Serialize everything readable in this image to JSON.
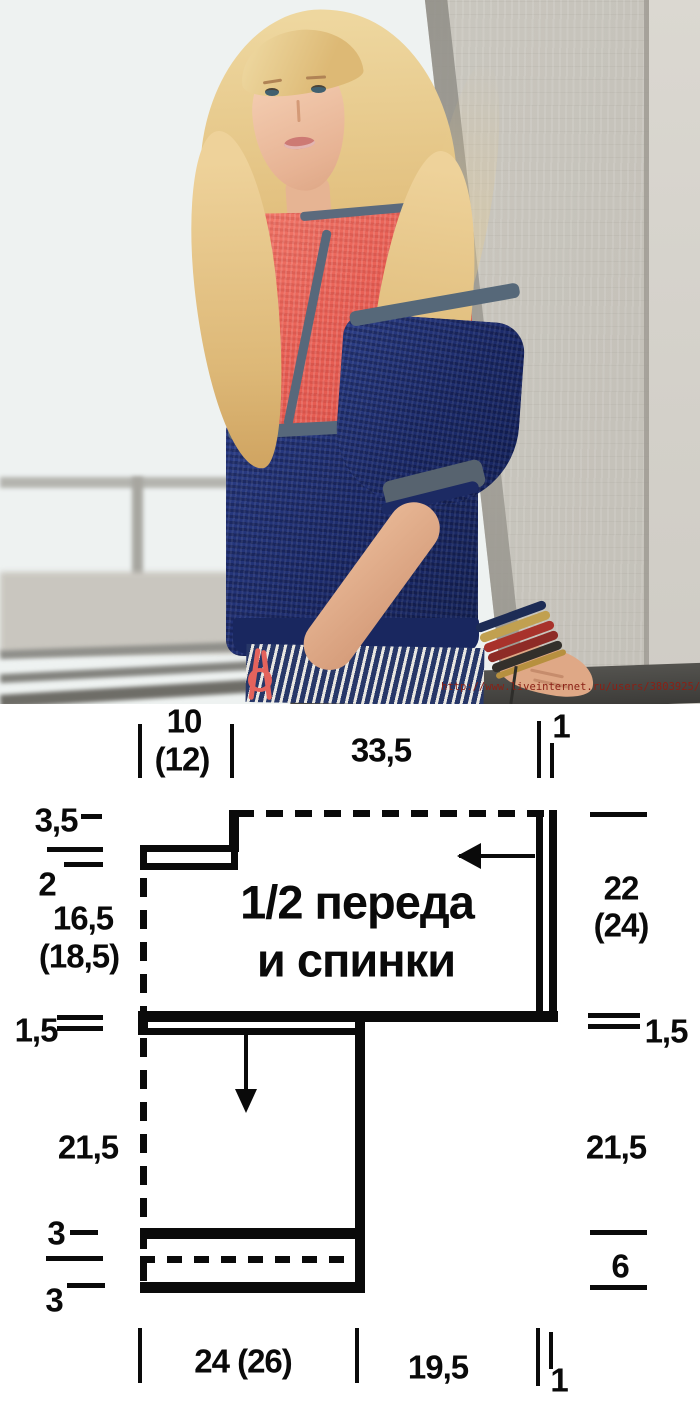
{
  "photo": {
    "watermark_url": "http://www.liveinternet.ru/users/3803925/",
    "colors": {
      "sweater_coral": "#e96156",
      "sweater_navy": "#1d2c6d",
      "trim_gray": "#566879",
      "wall_concrete": "#c3c0b8",
      "hair_blonde": "#e2c07f",
      "watermark_red": "#8a2015"
    }
  },
  "diagram": {
    "title_line1": "1/2 переда",
    "title_line2": "и спинки",
    "measurements": {
      "top_neck": "10",
      "top_neck_alt": "(12)",
      "top_width": "33,5",
      "top_cuff": "1",
      "left_neck_depth": "3,5",
      "left_shoulder": "2",
      "left_yoke": "16,5",
      "left_yoke_alt": "(18,5)",
      "left_trim": "1,5",
      "left_side": "21,5",
      "left_hem_upper": "3",
      "left_hem_lower": "3",
      "right_sleeve": "22",
      "right_sleeve_alt": "(24)",
      "right_trim": "1,5",
      "right_side": "21,5",
      "right_hem": "6",
      "bottom_body_width": "24 (26)",
      "bottom_sleeve_width": "19,5",
      "bottom_cuff": "1"
    }
  }
}
